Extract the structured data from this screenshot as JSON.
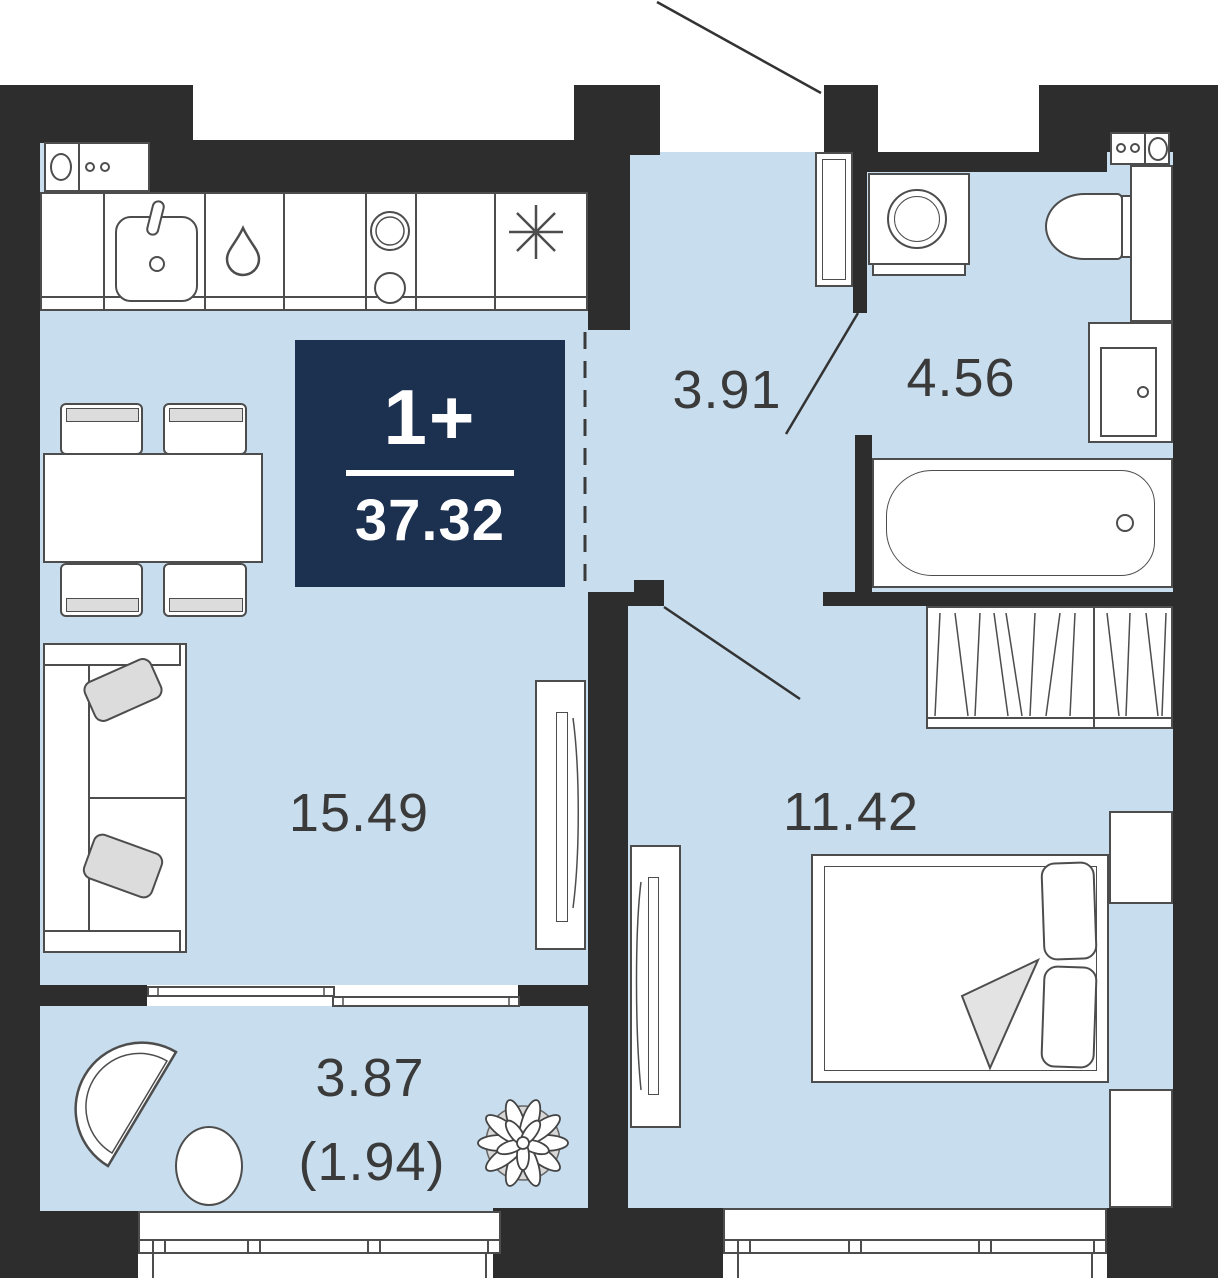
{
  "badge": {
    "rooms_label": "1+",
    "area_label": "37.32",
    "bg_color": "#1c3050",
    "text_color": "#ffffff"
  },
  "rooms": {
    "living": {
      "label": "15.49"
    },
    "corridor": {
      "label": "3.91"
    },
    "bathroom": {
      "label": "4.56"
    },
    "bedroom": {
      "label": "11.42"
    },
    "balcony": {
      "label": "3.87",
      "label_secondary": "(1.94)"
    }
  },
  "colors": {
    "wall": "#2d2d2d",
    "floor": "#c8dded",
    "outline": "#4d4d4d",
    "accent_gray": "#dcdcdc",
    "label_text": "#3a3a3a",
    "badge_bg": "#1c3050"
  },
  "icons": {
    "kitchen": [
      "kitchen-sink-icon",
      "water-drop-icon",
      "stove-burners-icon",
      "fridge-asterisk-icon",
      "vent-box-icon"
    ],
    "bathroom": [
      "washing-machine-icon",
      "toilet-icon",
      "vanity-sink-icon",
      "bathtub-icon",
      "vent-box-icon"
    ],
    "bedroom": [
      "wardrobe-hatch-icon",
      "double-bed-icon",
      "nightstand-icon",
      "tv-console-icon",
      "door-swing-icon"
    ],
    "living": [
      "dining-table-icon",
      "chair-icon",
      "sofa-icon",
      "tv-console-icon"
    ],
    "balcony": [
      "fan-armchair-icon",
      "round-table-icon",
      "plant-icon"
    ],
    "other": [
      "entrance-leader-line",
      "dashed-zone-divider",
      "window-glazing"
    ]
  }
}
